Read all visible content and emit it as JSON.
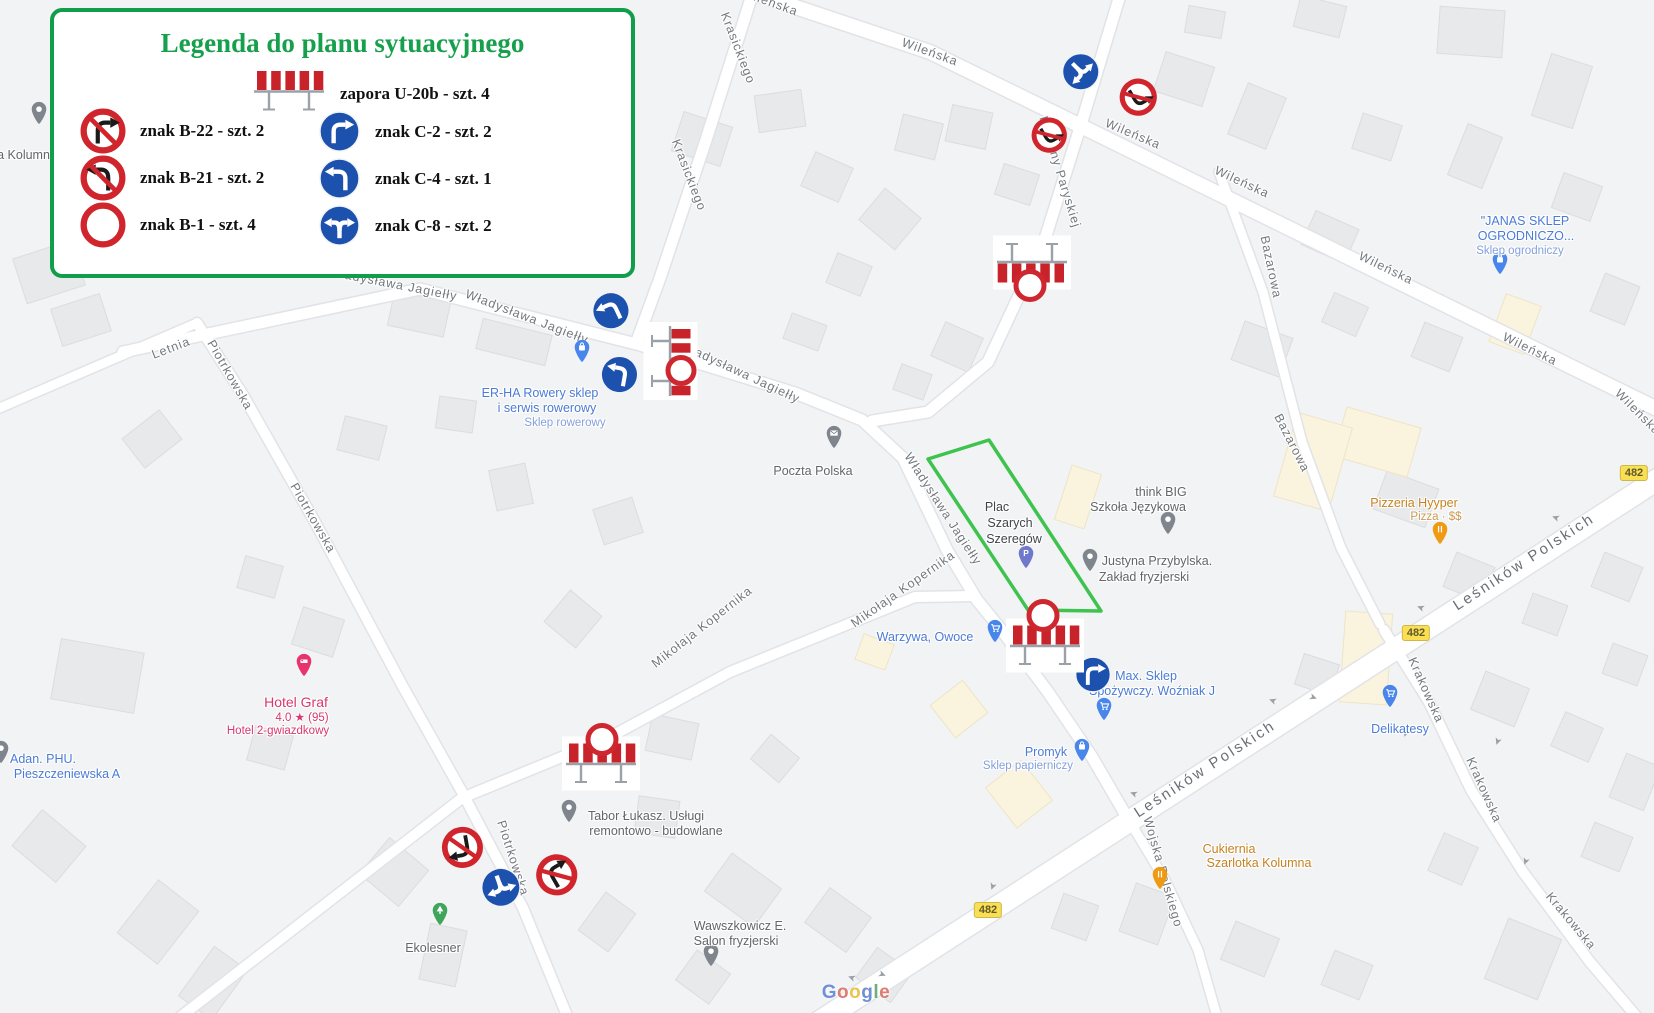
{
  "legend": {
    "title": "Legenda do planu sytuacyjnego",
    "barrier_label": "zapora U-20b - szt. 4",
    "rows_left": [
      {
        "icon": "b22",
        "label": "znak B-22 - szt. 2"
      },
      {
        "icon": "b21",
        "label": "znak B-21 - szt. 2"
      },
      {
        "icon": "b1",
        "label": "znak B-1 - szt. 4"
      }
    ],
    "rows_right": [
      {
        "icon": "c2",
        "label": "znak C-2 - szt. 2"
      },
      {
        "icon": "c4",
        "label": "znak C-4 - szt. 1"
      },
      {
        "icon": "c8",
        "label": "znak C-8 - szt. 2"
      }
    ]
  },
  "map": {
    "google_logo": "Google",
    "street_labels": [
      {
        "t": "Wileńska",
        "x": 770,
        "y": 2,
        "r": 20
      },
      {
        "t": "Wileńska",
        "x": 930,
        "y": 52,
        "r": 20
      },
      {
        "t": "Wileńska",
        "x": 1133,
        "y": 134,
        "r": 23
      },
      {
        "t": "Wileńska",
        "x": 1242,
        "y": 182,
        "r": 25
      },
      {
        "t": "Wileńska",
        "x": 1386,
        "y": 268,
        "r": 26
      },
      {
        "t": "Wileńska",
        "x": 1530,
        "y": 349,
        "r": 26
      },
      {
        "t": "Wileńska",
        "x": 1638,
        "y": 412,
        "r": 45
      },
      {
        "t": "Krasickiego",
        "x": 738,
        "y": 48,
        "r": 69
      },
      {
        "t": "Krasickiego",
        "x": 689,
        "y": 175,
        "r": 69
      },
      {
        "t": "Komuny Paryskiej",
        "x": 1060,
        "y": 172,
        "r": 73
      },
      {
        "t": "Bazarowa",
        "x": 1271,
        "y": 267,
        "r": 78
      },
      {
        "t": "Bazarowa",
        "x": 1292,
        "y": 443,
        "r": 63
      },
      {
        "t": "Władysława Jagiełły",
        "x": 393,
        "y": 284,
        "r": 11
      },
      {
        "t": "Władysława Jagiełły",
        "x": 527,
        "y": 317,
        "r": 21
      },
      {
        "t": "Władysława Jagiełły",
        "x": 740,
        "y": 372,
        "r": 25
      },
      {
        "t": "Władysława Jagiełły",
        "x": 943,
        "y": 509,
        "r": 57
      },
      {
        "t": "Letnia",
        "x": 171,
        "y": 348,
        "r": -21
      },
      {
        "t": "Piotrkowska",
        "x": 230,
        "y": 375,
        "r": 60
      },
      {
        "t": "Piotrkowska",
        "x": 313,
        "y": 518,
        "r": 60
      },
      {
        "t": "Piotrkowska",
        "x": 513,
        "y": 858,
        "r": 72
      },
      {
        "t": "Mikołaja Kopernika",
        "x": 702,
        "y": 627,
        "r": -38
      },
      {
        "t": "Mikołaja Kopernika",
        "x": 903,
        "y": 589,
        "r": -35
      },
      {
        "t": "Leśników Polskich",
        "x": 1205,
        "y": 769,
        "r": -33,
        "big": true
      },
      {
        "t": "Leśników Polskich",
        "x": 1524,
        "y": 562,
        "r": -33,
        "big": true
      },
      {
        "t": "Krakowska",
        "x": 1426,
        "y": 690,
        "r": 66
      },
      {
        "t": "Krakowska",
        "x": 1484,
        "y": 790,
        "r": 66
      },
      {
        "t": "Krakowska",
        "x": 1571,
        "y": 921,
        "r": 50
      },
      {
        "t": "Wojska Polskiego",
        "x": 1163,
        "y": 872,
        "r": 74
      }
    ],
    "pois": [
      {
        "name": "kolumna",
        "pin": {
          "x": 39,
          "y": 118,
          "k": "gray"
        },
        "texts": [
          {
            "t": "a Kolumna",
            "x": 27,
            "y": 155,
            "c": "gray"
          }
        ]
      },
      {
        "name": "er-ha-rowery",
        "pin": {
          "x": 582,
          "y": 356,
          "k": "bag"
        },
        "texts": [
          {
            "t": "ER-HA Rowery sklep",
            "x": 540,
            "y": 393,
            "c": "blue"
          },
          {
            "t": "i serwis rowerowy",
            "x": 547,
            "y": 408,
            "c": "blue"
          },
          {
            "t": "Sklep rowerowy",
            "x": 565,
            "y": 423,
            "c": "blue2"
          }
        ]
      },
      {
        "name": "poczta-polska",
        "pin": {
          "x": 834,
          "y": 442,
          "k": "env"
        },
        "texts": [
          {
            "t": "Poczta Polska",
            "x": 813,
            "y": 471,
            "c": "gray"
          }
        ]
      },
      {
        "name": "plac-szarych-szeregow",
        "pin": {
          "x": 1026,
          "y": 562,
          "k": "park"
        },
        "texts": [
          {
            "t": "Plac",
            "x": 997,
            "y": 507,
            "c": "dark"
          },
          {
            "t": "Szarych",
            "x": 1010,
            "y": 523,
            "c": "dark"
          },
          {
            "t": "Szeregów",
            "x": 1014,
            "y": 539,
            "c": "dark"
          }
        ]
      },
      {
        "name": "think-big",
        "pin": {
          "x": 1168,
          "y": 528,
          "k": "gray"
        },
        "texts": [
          {
            "t": "think BIG",
            "x": 1161,
            "y": 492,
            "c": "gray"
          },
          {
            "t": "Szkoła Językowa",
            "x": 1138,
            "y": 507,
            "c": "gray"
          }
        ]
      },
      {
        "name": "justyna-przybylska",
        "pin": {
          "x": 1090,
          "y": 565,
          "k": "gray"
        },
        "texts": [
          {
            "t": "Justyna Przybylska.",
            "x": 1157,
            "y": 561,
            "c": "gray"
          },
          {
            "t": "Zakład fryzjerski",
            "x": 1144,
            "y": 577,
            "c": "gray"
          }
        ]
      },
      {
        "name": "warzywa-owoce",
        "pin": {
          "x": 995,
          "y": 636,
          "k": "cart"
        },
        "texts": [
          {
            "t": "Warzywa, Owoce",
            "x": 925,
            "y": 637,
            "c": "blue"
          }
        ]
      },
      {
        "name": "max-sklep",
        "pin": {
          "x": 1104,
          "y": 714,
          "k": "cart"
        },
        "texts": [
          {
            "t": "Max. Sklep",
            "x": 1146,
            "y": 676,
            "c": "blue"
          },
          {
            "t": "Spożywczy. Woźniak J",
            "x": 1152,
            "y": 691,
            "c": "blue"
          }
        ]
      },
      {
        "name": "promyk",
        "pin": {
          "x": 1082,
          "y": 755,
          "k": "bag"
        },
        "texts": [
          {
            "t": "Promyk",
            "x": 1046,
            "y": 752,
            "c": "blue"
          },
          {
            "t": "Sklep papierniczy",
            "x": 1028,
            "y": 766,
            "c": "blue2"
          }
        ]
      },
      {
        "name": "delikatesy",
        "pin": {
          "x": 1390,
          "y": 701,
          "k": "cart"
        },
        "texts": [
          {
            "t": "Delikatesy",
            "x": 1400,
            "y": 729,
            "c": "blue"
          }
        ]
      },
      {
        "name": "pizzeria-hyyper",
        "pin": {
          "x": 1440,
          "y": 538,
          "k": "food"
        },
        "texts": [
          {
            "t": "Pizzeria Hyyper",
            "x": 1414,
            "y": 503,
            "c": "orange"
          },
          {
            "t": "Pizza · $$",
            "x": 1436,
            "y": 517,
            "c": "orange2"
          }
        ]
      },
      {
        "name": "janas-sklep",
        "pin": {
          "x": 1500,
          "y": 268,
          "k": "bag"
        },
        "texts": [
          {
            "t": "\"JANAS SKLEP",
            "x": 1525,
            "y": 221,
            "c": "blue"
          },
          {
            "t": "OGRODNICZO...",
            "x": 1526,
            "y": 236,
            "c": "blue"
          },
          {
            "t": "Sklep ogrodniczy",
            "x": 1520,
            "y": 251,
            "c": "blue2"
          }
        ]
      },
      {
        "name": "hotel-graf",
        "pin": {
          "x": 304,
          "y": 670,
          "k": "hotel"
        },
        "texts": [
          {
            "t": "Hotel Graf",
            "x": 296,
            "y": 702,
            "c": "pink"
          },
          {
            "t": "4.0 ★ (95)",
            "x": 302,
            "y": 717,
            "c": "pink2"
          },
          {
            "t": "Hotel 2-gwiazdkowy",
            "x": 278,
            "y": 731,
            "c": "pink2"
          }
        ]
      },
      {
        "name": "adan-phu",
        "pin": {
          "x": 1,
          "y": 757,
          "k": "dot"
        },
        "texts": [
          {
            "t": "Adan. PHU.",
            "x": 43,
            "y": 759,
            "c": "blue"
          },
          {
            "t": "Pieszczeniewska A",
            "x": 67,
            "y": 774,
            "c": "blue"
          }
        ]
      },
      {
        "name": "tabor-lukasz",
        "pin": {
          "x": 569,
          "y": 816,
          "k": "gray"
        },
        "texts": [
          {
            "t": "Tabor Łukasz. Usługi",
            "x": 646,
            "y": 816,
            "c": "gray"
          },
          {
            "t": "remontowo - budowlane",
            "x": 656,
            "y": 831,
            "c": "gray"
          }
        ]
      },
      {
        "name": "ekolesner",
        "pin": {
          "x": 440,
          "y": 919,
          "k": "tree"
        },
        "texts": [
          {
            "t": "Ekolesner",
            "x": 433,
            "y": 948,
            "c": "gray"
          }
        ]
      },
      {
        "name": "wawszkowicz",
        "pin": {
          "x": 711,
          "y": 960,
          "k": "gray"
        },
        "texts": [
          {
            "t": "Wawszkowicz E.",
            "x": 740,
            "y": 926,
            "c": "gray"
          },
          {
            "t": "Salon fryzjerski",
            "x": 736,
            "y": 941,
            "c": "gray"
          }
        ]
      },
      {
        "name": "cukiernia",
        "pin": {
          "x": 1160,
          "y": 883,
          "k": "food"
        },
        "texts": [
          {
            "t": "Cukiernia",
            "x": 1229,
            "y": 849,
            "c": "orange"
          },
          {
            "t": "Szarlotka Kolumna",
            "x": 1259,
            "y": 863,
            "c": "orange"
          }
        ]
      }
    ],
    "route_badges": [
      {
        "t": "482",
        "x": 1634,
        "y": 473
      },
      {
        "t": "482",
        "x": 1416,
        "y": 633
      },
      {
        "t": "482",
        "x": 988,
        "y": 910
      }
    ],
    "signs": [
      {
        "type": "c8",
        "x": 1079,
        "y": 70,
        "d": 40,
        "rot": 135
      },
      {
        "type": "b21",
        "x": 1137,
        "y": 95,
        "d": 38,
        "rot": 150
      },
      {
        "type": "b21",
        "x": 1048,
        "y": 133,
        "d": 36,
        "rot": 150
      },
      {
        "type": "c4",
        "x": 612,
        "y": 313,
        "d": 40,
        "rot": -25
      },
      {
        "type": "c4",
        "x": 619,
        "y": 377,
        "d": 40,
        "rot": 10
      },
      {
        "type": "c2",
        "x": 1093,
        "y": 677,
        "d": 38,
        "rot": 0
      },
      {
        "type": "b22",
        "x": 462,
        "y": 845,
        "d": 42,
        "rot": 170
      },
      {
        "type": "c8",
        "x": 500,
        "y": 885,
        "d": 42,
        "rot": 160
      },
      {
        "type": "b22",
        "x": 558,
        "y": 877,
        "d": 42,
        "rot": -30
      }
    ],
    "barriers": [
      {
        "x": 1032,
        "y": 260,
        "rot": 180
      },
      {
        "x": 668,
        "y": 361,
        "rot": 90
      },
      {
        "x": 1045,
        "y": 648,
        "rot": 0
      },
      {
        "x": 601,
        "y": 766,
        "rot": 0
      }
    ],
    "b1_circles": [
      {
        "x": 1030,
        "y": 288,
        "r": 14
      },
      {
        "x": 681,
        "y": 373,
        "r": 13
      },
      {
        "x": 1043,
        "y": 618,
        "r": 14
      },
      {
        "x": 602,
        "y": 742,
        "r": 14
      }
    ]
  }
}
